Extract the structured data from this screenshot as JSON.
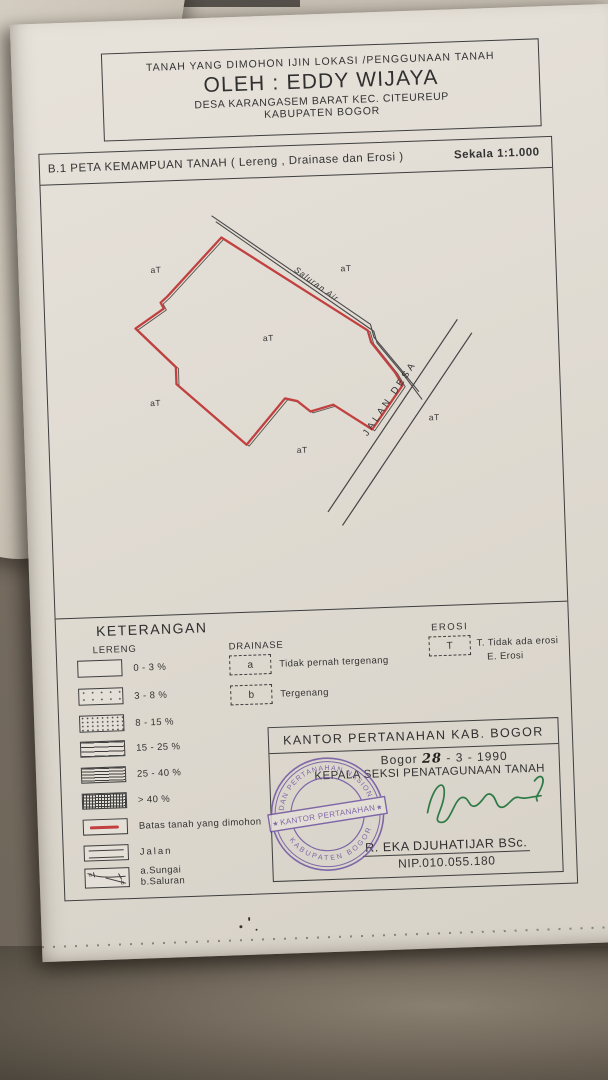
{
  "colors": {
    "boundary_red": "#c2403f",
    "stamp_purple": "#6b4fa0",
    "signature_green": "#2e7a46",
    "paper": "#e2ddd5",
    "background": "#6e655a"
  },
  "header": {
    "line1": "TANAH YANG DIMOHON IJIN LOKASI /PENGGUNAAN TANAH",
    "line2": "OLEH : EDDY WIJAYA",
    "line3": "DESA KARANGASEM BARAT KEC. CITEUREUP",
    "line4": "KABUPATEN BOGOR"
  },
  "map_title": {
    "code_title": "B.1 PETA KEMAMPUAN TANAH ( Lereng , Drainase dan Erosi )",
    "scale": "Sekala 1:1.000"
  },
  "map": {
    "road_label": "JALAN DESA",
    "channel_label": "Saluran Air",
    "unit_label": "aT",
    "unit_marks": [
      {
        "x": 107,
        "y": 91
      },
      {
        "x": 297,
        "y": 96
      },
      {
        "x": 217,
        "y": 163
      },
      {
        "x": 102,
        "y": 224
      },
      {
        "x": 247,
        "y": 276
      },
      {
        "x": 380,
        "y": 248
      }
    ]
  },
  "legend": {
    "heading": "KETERANGAN",
    "lereng": {
      "title": "LERENG",
      "ranges": [
        "0 - 3 %",
        "3 - 8 %",
        "8 - 15 %",
        "15 - 25 %",
        "25 - 40 %",
        "> 40 %"
      ],
      "boundary_label": "Batas tanah yang dimohon",
      "road_label": "Jalan",
      "river_label_a": "a.Sungai",
      "river_label_b": "b.Saluran"
    },
    "drainase": {
      "title": "DRAINASE",
      "a_symbol": "a",
      "a_label": "Tidak pernah tergenang",
      "b_symbol": "b",
      "b_label": "Tergenang"
    },
    "erosi": {
      "title": "EROSI",
      "symbol": "T",
      "line1": "T. Tidak ada erosi",
      "line2": "E. Erosi"
    }
  },
  "office": {
    "title": "KANTOR PERTANAHAN KAB. BOGOR",
    "city": "Bogor",
    "date_hand": "28",
    "date_rest": "- 3 - 1990",
    "role": "KEPALA SEKSI PENATAGUNAAN TANAH",
    "name": "R. EKA DJUHATIJAR BSc.",
    "nip": "NIP.010.055.180",
    "stamp": {
      "top": "BADAN PERTANAHAN NASIONAL",
      "banner": "KANTOR PERTANAHAN",
      "bottom": "KABUPATEN BOGOR",
      "star": "★"
    }
  }
}
